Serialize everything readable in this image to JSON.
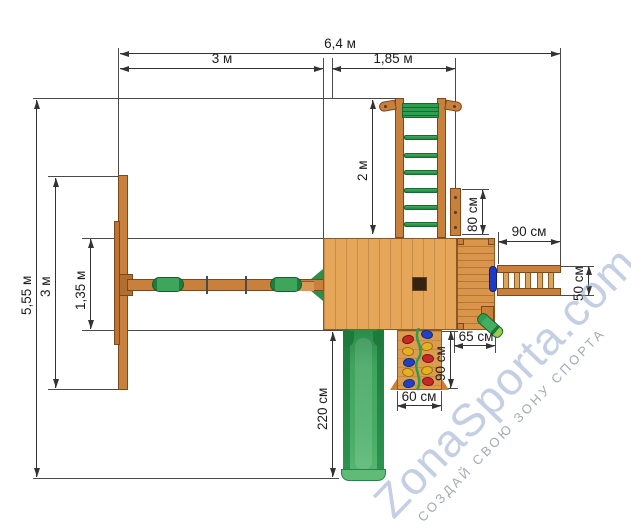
{
  "watermark": {
    "brand": "ZonaSporta.com",
    "tagline": "СОЗДАЙ СВОЮ ЗОНУ СПОРТА"
  },
  "dimensions": {
    "overall_width": "6,4 м",
    "span_left": "3 м",
    "span_right": "1,85 м",
    "monkey_bars_length": "2 м",
    "access_board": "80 см",
    "bridge_length": "90 см",
    "bridge_width": "50 см",
    "balcony_depth": "65 см",
    "rock_wall_length": "90 см",
    "rock_wall_width": "60 см",
    "slide_length": "220 см",
    "overall_depth": "5,55 м",
    "swing_frame_depth": "3 м",
    "deck_depth": "1,35 м"
  },
  "colors": {
    "wood_light": "#e5a659",
    "wood_mid": "#c9803c",
    "wood_outline": "#7a4a1e",
    "green": "#2f9e4f",
    "slide_green": "#3fa55e",
    "hold_red": "#c62828",
    "hold_yellow": "#e6b023",
    "hold_blue": "#2140c4",
    "dimension_line": "#3a3a3a",
    "watermark_blue": "#94a8ce",
    "watermark_gray": "#8a929e"
  }
}
